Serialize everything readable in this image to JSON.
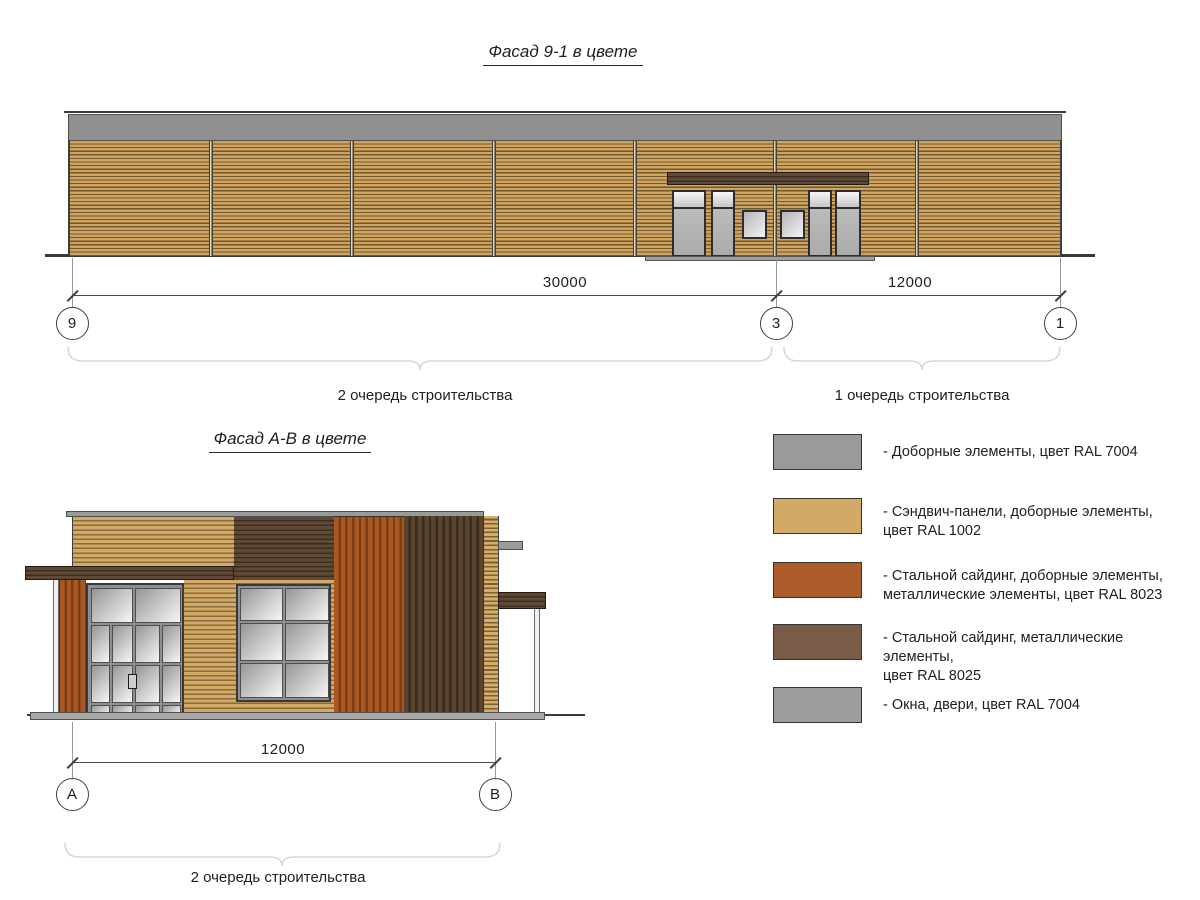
{
  "titles": {
    "facade1": "Фасад 9-1 в цвете",
    "facade2": "Фасад А-В в цвете"
  },
  "top_facade": {
    "dim_left": "30000",
    "dim_right": "12000",
    "axis_left": "9",
    "axis_mid": "3",
    "axis_right": "1",
    "phase_left": "2 очередь строительства",
    "phase_right": "1 очередь строительства"
  },
  "bottom_facade": {
    "dim": "12000",
    "axis_left": "А",
    "axis_right": "В",
    "phase": "2 очередь строительства"
  },
  "legend": {
    "items": [
      {
        "label": "- Доборные элементы, цвет RAL 7004",
        "color": "#9b9b99"
      },
      {
        "label": "- Сэндвич-панели, доборные элементы,\nцвет RAL 1002",
        "color": "#d2a966"
      },
      {
        "label": "- Стальной сайдинг, доборные элементы,\nметаллические элементы, цвет RAL 8023",
        "color": "#ad5c2b"
      },
      {
        "label": "- Стальной сайдинг, металлические элементы,\nцвет RAL 8025",
        "color": "#7a5b48"
      },
      {
        "label": "- Окна, двери, цвет RAL 7004",
        "color": "#9d9d9b"
      }
    ]
  }
}
